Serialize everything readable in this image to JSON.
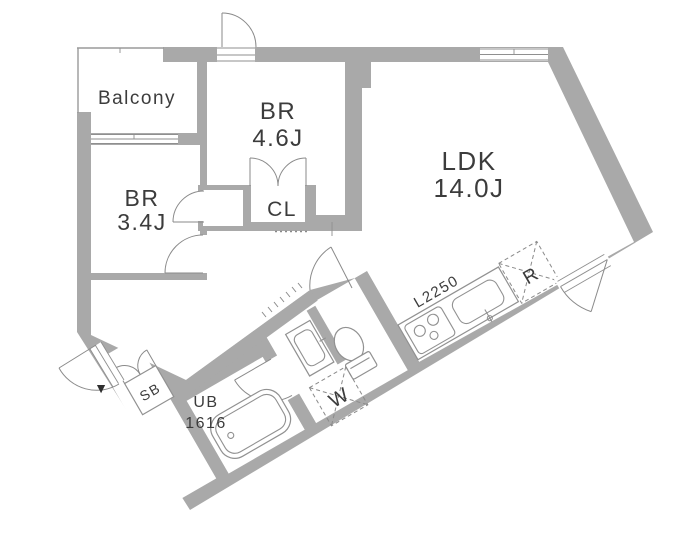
{
  "page": {
    "title": "Apartment floor plan"
  },
  "colors": {
    "wall": "#a9a9a9",
    "line": "#8f8f8f",
    "fixture": "#919191",
    "text": "#3c3c3c"
  },
  "rooms": {
    "balcony": {
      "label": "Balcony"
    },
    "bedroom1": {
      "label": "BR",
      "size": "4.6J"
    },
    "bedroom2": {
      "label": "BR",
      "size": "3.4J"
    },
    "ldk": {
      "label": "LDK",
      "size": "14.0J"
    },
    "closet": {
      "label": "CL"
    },
    "bath": {
      "label": "UB",
      "size": "1616"
    },
    "shoebox": {
      "label": "SB"
    },
    "washer": {
      "label": "W"
    },
    "fridge": {
      "label": "R"
    },
    "kitchen_counter": {
      "label": "L2250"
    }
  },
  "icons": {
    "entrance_marker": "▼"
  }
}
